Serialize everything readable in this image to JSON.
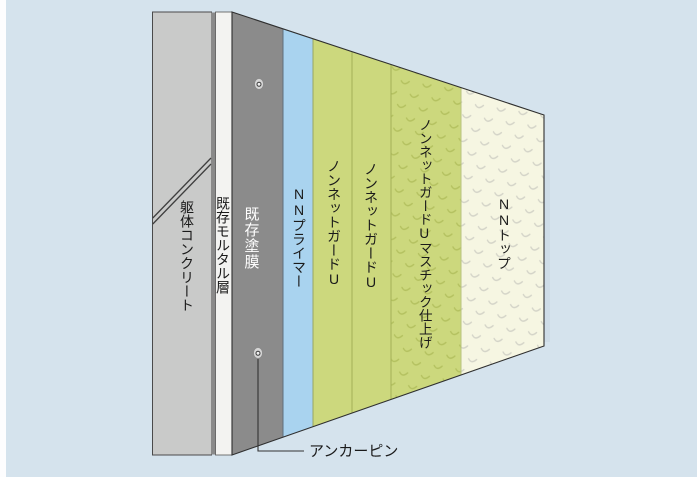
{
  "diagram": {
    "background_color": "#d5e3ed",
    "left_margin_color": "#fdfdfe",
    "outline_color": "#2f2f2f",
    "layers": [
      {
        "id": "concrete",
        "label": "躯体コンクリート",
        "color": "#c9cac9",
        "edge_color": "#8a8a8a",
        "text_color": "#1a1a1a"
      },
      {
        "id": "mortar",
        "label": "既存モルタル層",
        "color": "#f3f3f1",
        "text_color": "#1a1a1a"
      },
      {
        "id": "existing-coating",
        "label": "既存塗膜",
        "color": "#8b8b8b",
        "text_color": "#ffffff"
      },
      {
        "id": "nn-primer",
        "label": "NNプライマー",
        "color": "#a9d3ef",
        "text_color": "#1a1a1a"
      },
      {
        "id": "nonnet-guard-u-1",
        "label": "ノンネットガードU",
        "color": "#ccd87d",
        "text_color": "#1a1a1a"
      },
      {
        "id": "nonnet-guard-u-2",
        "label": "ノンネットガードU",
        "color": "#ccd87d",
        "text_color": "#1a1a1a"
      },
      {
        "id": "nonnet-guard-u-mastic",
        "label": "ノンネットガードUマスチック仕上げ",
        "color": "#ccd87d",
        "texture_color": "#b4c160",
        "text_color": "#1a1a1a"
      },
      {
        "id": "nn-top",
        "label": "NNトップ",
        "color": "#f6f6e2",
        "texture_color": "#d4d4c8",
        "text_color": "#1a1a1a"
      }
    ],
    "annotations": [
      {
        "id": "anchor-pin",
        "label": "アンカーピン"
      }
    ]
  }
}
